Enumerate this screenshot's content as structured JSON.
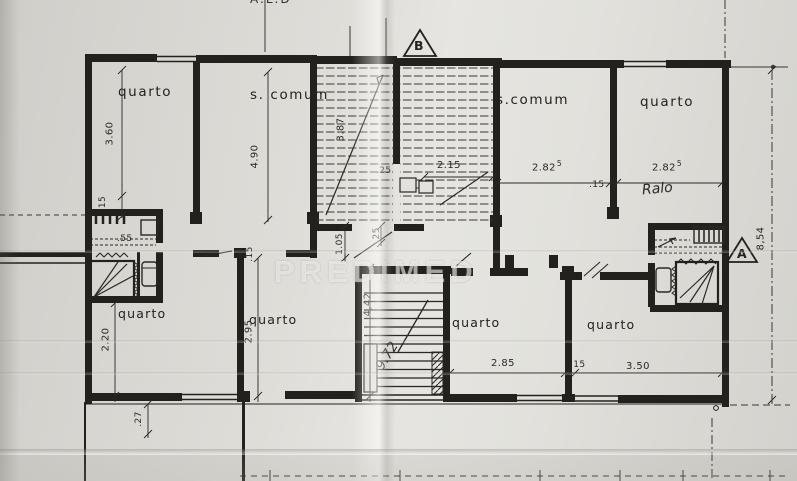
{
  "document": {
    "kind": "scanned architectural floor plan",
    "watermark": "PREDIMED",
    "top_edge_note": "A.L.D"
  },
  "section_markers": {
    "a": "A",
    "b": "B"
  },
  "rooms": {
    "top_left_bedroom": "quarto",
    "top_left_common_room": "s. comum",
    "top_right_common_room": "s.comum",
    "top_right_bedroom": "quarto",
    "lower_left_bedroom": "quarto",
    "lower_center_left_bedroom": "quarto",
    "lower_center_right_bedroom": "quarto",
    "lower_right_bedroom": "quarto",
    "handwritten_note": "Ralo",
    "handwritten_measure": "9.72"
  },
  "dimensions": {
    "left_room_depth": "3.60",
    "left_wall_offset": "15",
    "common_room_depth": "4.90",
    "stair_depth": "3.87",
    "stair_width": "2.15",
    "stair_offset": ".25",
    "common_room_width": "2.82",
    "common_room_width_sup": "5",
    "top_partition": ".15",
    "right_bedroom_width": "2.82",
    "right_bedroom_width_sup": "5",
    "right_side_height": "8,54",
    "bath_fixture": ".55",
    "entry_width": "1.05",
    "entry_offset": ".25",
    "lower_partition_left": ".15",
    "lower_left_depth": "2.20",
    "lower_center_depth": "2.95",
    "stairwell_depth": "4,42",
    "lower_center_right_width": "2.85",
    "lower_partition_right": ".15",
    "lower_right_width": "3.50",
    "bottom_offset": ".27"
  }
}
